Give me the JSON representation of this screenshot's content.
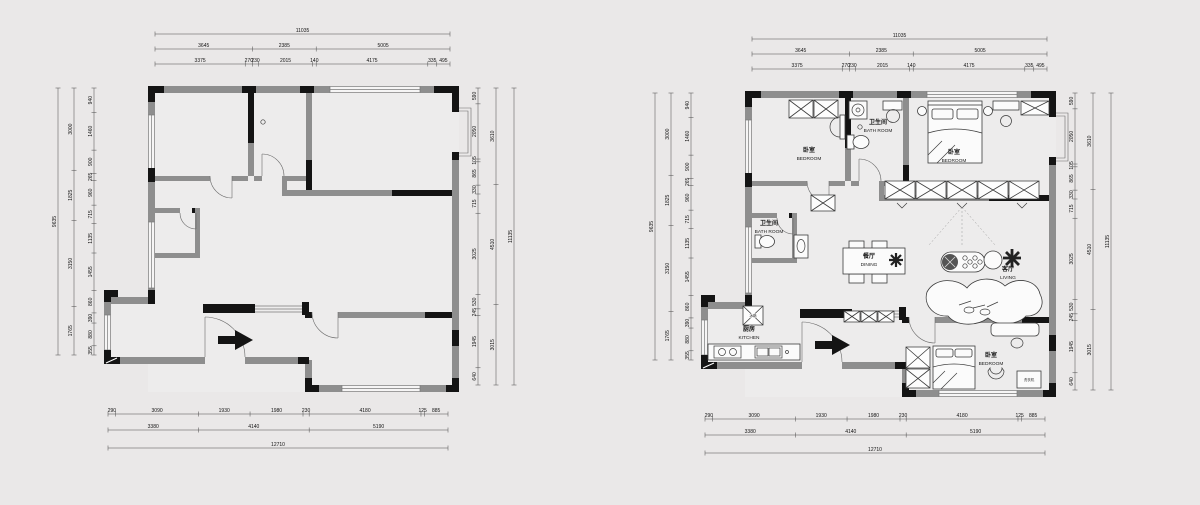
{
  "page": {
    "background": "#eae8e8"
  },
  "dims": {
    "top_total": [
      11035
    ],
    "top_row2": [
      3645,
      2385,
      5005
    ],
    "top_row3": [
      3375,
      270,
      230,
      2015,
      140,
      4175,
      335,
      495
    ],
    "bottom_row1": [
      290,
      3090,
      1930,
      1980,
      230,
      4180,
      125,
      885
    ],
    "bottom_row2": [
      3380,
      4140,
      5190
    ],
    "bottom_total": [
      12710
    ],
    "left_inner": [
      940,
      1460,
      900,
      265,
      960,
      715,
      1135,
      1455,
      860,
      390,
      880,
      355
    ],
    "left_mid": [
      3000,
      1825,
      3150,
      1765
    ],
    "left_total": [
      9635
    ],
    "right_inner": [
      590,
      2050,
      105,
      865,
      330,
      715,
      3025,
      530,
      245,
      1945,
      640
    ],
    "right_mid": [
      3610,
      4510,
      3015
    ],
    "right_total": [
      11135
    ]
  },
  "rooms": {
    "bedroom1": {
      "zh": "卧室",
      "en": "BEDROOM"
    },
    "bath1": {
      "zh": "卫生间",
      "en": "BATH ROOM"
    },
    "bedroom2": {
      "zh": "卧室",
      "en": "BEDROOM"
    },
    "bath2": {
      "zh": "卫生间",
      "en": "BATH ROOM"
    },
    "dining": {
      "zh": "餐厅",
      "en": "DINING"
    },
    "living": {
      "zh": "客厅",
      "en": "LIVING"
    },
    "kitchen": {
      "zh": "厨房",
      "en": "KITCHEN"
    },
    "bedroom3": {
      "zh": "卧室",
      "en": "BEDROOM"
    },
    "fridge": {
      "zh": "冰箱"
    },
    "washer": {
      "zh": "洗衣机"
    }
  }
}
